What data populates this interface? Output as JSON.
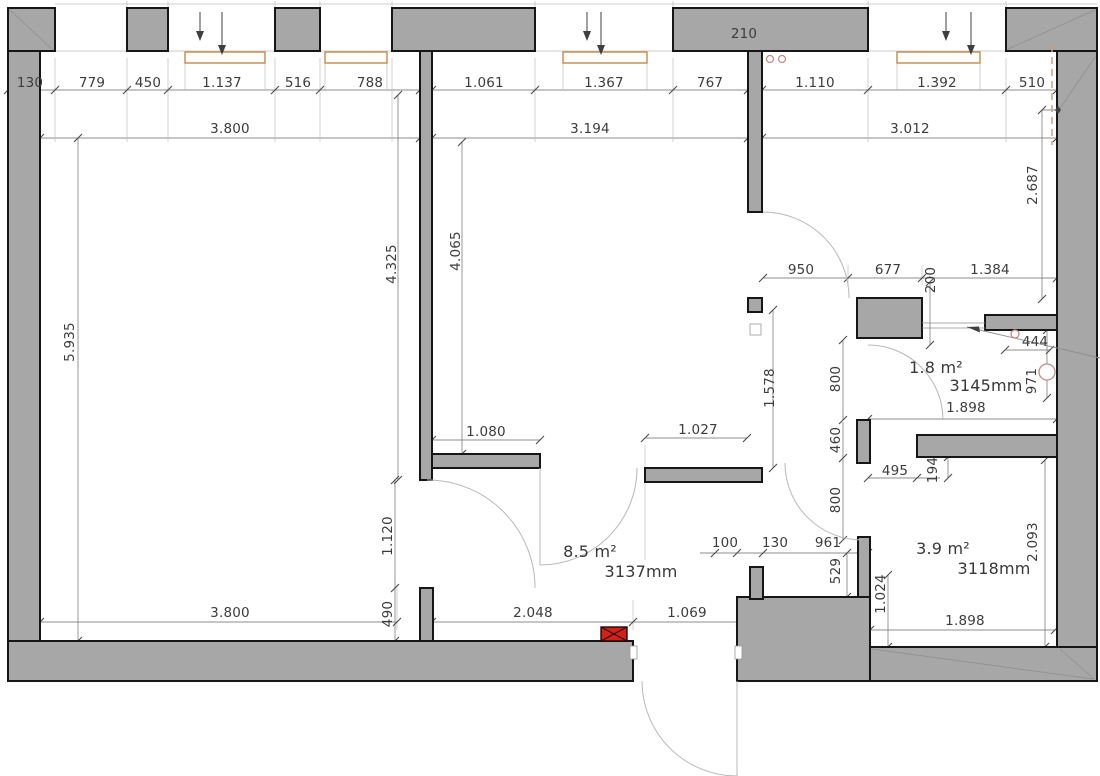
{
  "colors": {
    "wall_fill": "#a7a7a7",
    "wall_outline": "#161616",
    "dimension_line": "#8c8c8c",
    "text": "#3c3c3c",
    "window_frame": "#c18a50",
    "alert_red": "#d2201a",
    "fixture_pink": "#c48a8a",
    "overhead_dash": "#c9a184"
  },
  "dims": {
    "top_chain": [
      "130",
      "779",
      "450",
      "1.137",
      "516",
      "788",
      "1.061",
      "1.367",
      "767",
      "1.110",
      "1.392",
      "510"
    ],
    "top_totals": [
      "3.800",
      "3.194",
      "3.012"
    ],
    "lintel": "210",
    "left_height": "5.935",
    "room1_inner_height": "4.325",
    "room2_inner_height": "4.065",
    "room2_bottom_left": "1.080",
    "room2_bottom_right": "1.027",
    "door_left": "1.120",
    "stub_left": "490",
    "bottom_left_width": "3.800",
    "hall_bottom_left": "2.048",
    "hall_bottom_door": "1.069",
    "upper_hall": [
      "950",
      "677",
      "200",
      "1.384"
    ],
    "right_upper_height": "2.687",
    "hall_heights": [
      "1.578",
      "800",
      "460",
      "800"
    ],
    "wc_door": "444",
    "wc_height": "971",
    "wc_width": "1.898",
    "hall_small": [
      "100",
      "130",
      "961",
      "529"
    ],
    "room4_jog_w": "495",
    "room4_jog_h": "194",
    "room4_door": "1.024",
    "room4_height": "2.093",
    "room4_width": "1.898"
  },
  "rooms": {
    "hall": {
      "area": "8.5 m²",
      "length": "3137mm"
    },
    "wc": {
      "area": "1.8 m²",
      "length": "3145mm"
    },
    "room4": {
      "area": "3.9 m²",
      "length": "3118mm"
    }
  }
}
